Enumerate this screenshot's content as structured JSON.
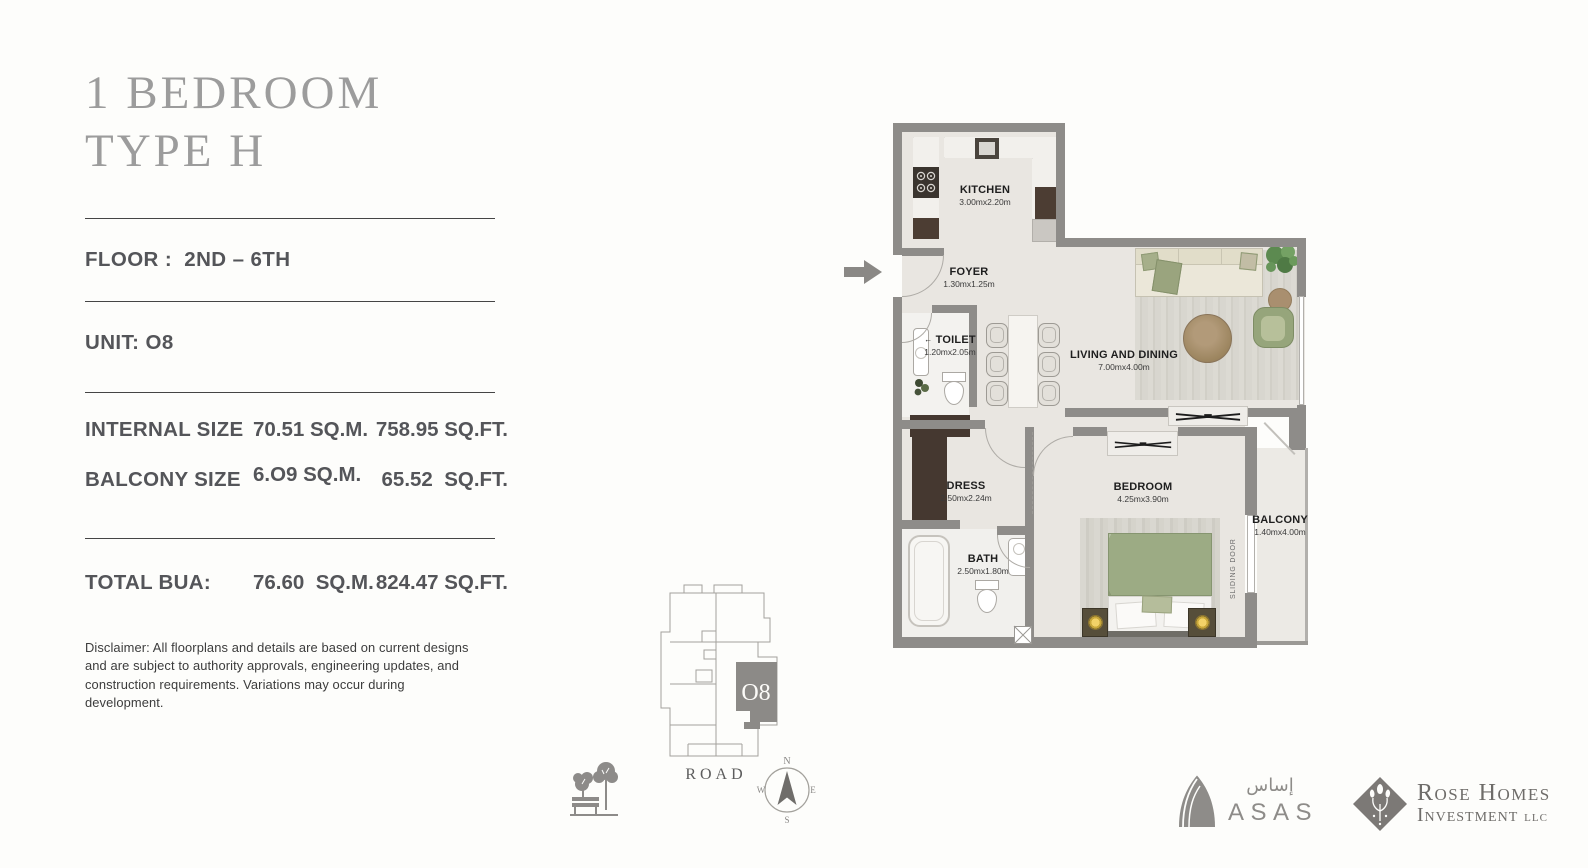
{
  "panel": {
    "title_line1": "1 BEDROOM",
    "title_line2": "TYPE H",
    "floor_label": "FLOOR : ",
    "floor_value": "2ND – 6TH",
    "unit_label": "UNIT: ",
    "unit_value": "O8",
    "size_rows": [
      {
        "label": "INTERNAL SIZE",
        "sqm": "70.51 SQ.M.",
        "sqft": "758.95 SQ.FT."
      },
      {
        "label": "BALCONY SIZE",
        "sqm": "6.O9 SQ.M.",
        "sqft": "65.52  SQ.FT."
      }
    ],
    "total_row": {
      "label": "TOTAL BUA:",
      "sqm": "76.60  SQ.M.",
      "sqft": "824.47 SQ.FT."
    },
    "disclaimer": "Disclaimer: All floorplans and details are based on current designs and are subject to authority approvals, engineering updates, and construction requirements. Variations may occur during development."
  },
  "floorplan": {
    "rooms": [
      {
        "name": "KITCHEN",
        "dims": "3.00mx2.20m"
      },
      {
        "name": "FOYER",
        "dims": "1.30mx1.25m"
      },
      {
        "name": "TOILET",
        "dims": "1.20mx2.05m"
      },
      {
        "name": "LIVING AND DINING",
        "dims": "7.00mx4.00m"
      },
      {
        "name": "DRESS",
        "dims": "2.50mx2.24m"
      },
      {
        "name": "BATH",
        "dims": "2.50mx1.80m"
      },
      {
        "name": "BEDROOM",
        "dims": "4.25mx3.90m"
      },
      {
        "name": "BALCONY",
        "dims": "1.40mx4.00m"
      }
    ],
    "sliding_door_label": "SLIDING DOOR",
    "toilet_marker": "←"
  },
  "keyplan": {
    "unit_number": "O8",
    "road_label": "ROAD",
    "compass": {
      "n": "N",
      "e": "E",
      "s": "S",
      "w": "W"
    }
  },
  "branding": {
    "asas": {
      "arabic": "إساس",
      "name": "ASAS"
    },
    "rose": {
      "line1": "Rose Homes",
      "line2": "Investment",
      "suffix": "LLC"
    }
  },
  "colors": {
    "wall": "#8e8c89",
    "floor": "#e9e6e1",
    "accent_dark": "#453830",
    "title_gray": "#9c9c9c"
  }
}
